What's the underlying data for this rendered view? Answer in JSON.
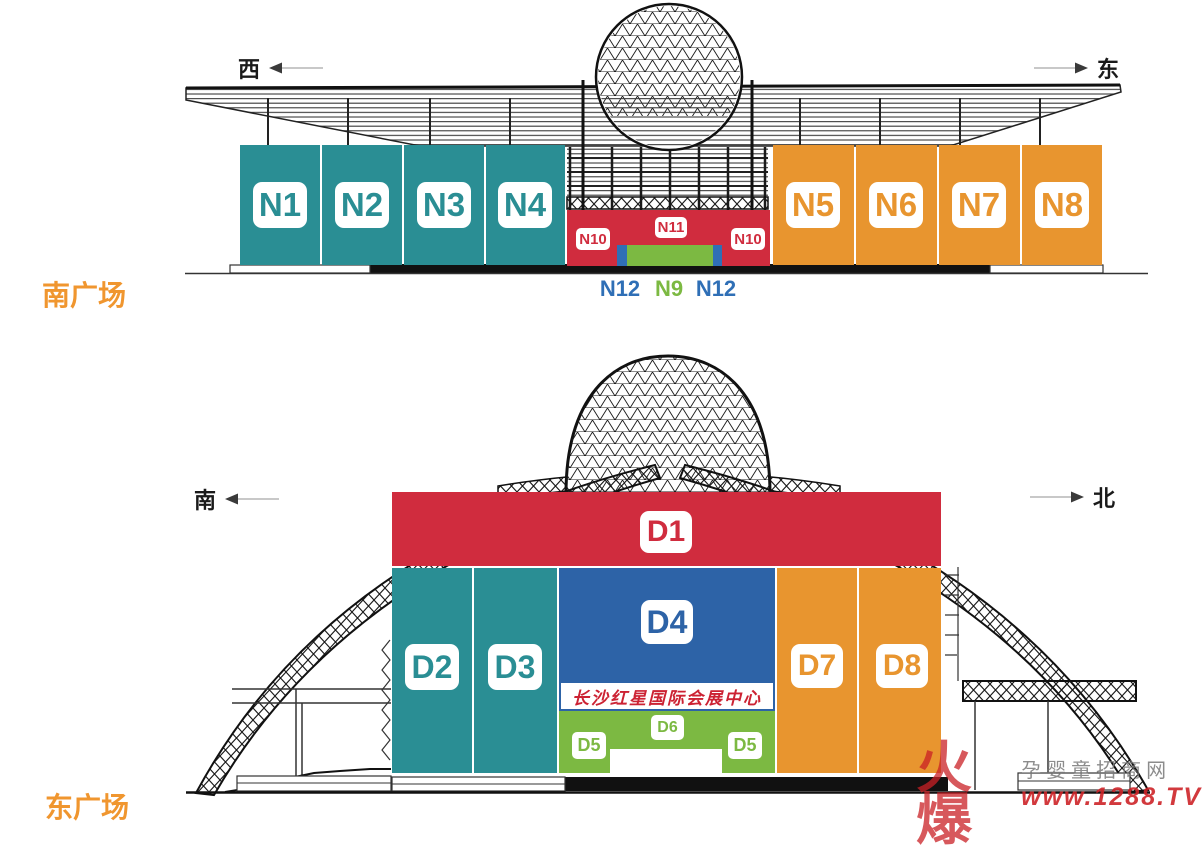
{
  "south": {
    "title": "南广场",
    "dir_left": "西",
    "dir_right": "东",
    "halls": {
      "n1": "N1",
      "n2": "N2",
      "n3": "N3",
      "n4": "N4",
      "n5": "N5",
      "n6": "N6",
      "n7": "N7",
      "n8": "N8",
      "n10": "N10",
      "n11": "N11"
    },
    "ground": {
      "n12": "N12",
      "n9": "N9"
    }
  },
  "east": {
    "title": "东广场",
    "dir_left": "南",
    "dir_right": "北",
    "halls": {
      "d1": "D1",
      "d2": "D2",
      "d3": "D3",
      "d4": "D4",
      "d5": "D5",
      "d6": "D6",
      "d7": "D7",
      "d8": "D8"
    },
    "banner": "长沙红星国际会展中心"
  },
  "watermark": {
    "brand": "火爆",
    "site": "孕婴童招商网",
    "url": "www.1288.TV"
  },
  "colors": {
    "teal": "#2a8e94",
    "orange": "#e8952f",
    "red": "#d02c3e",
    "blue": "#2d63a7",
    "green": "#7cb942",
    "title_orange": "#f0962f",
    "label_blue": "#2f6fb6"
  }
}
